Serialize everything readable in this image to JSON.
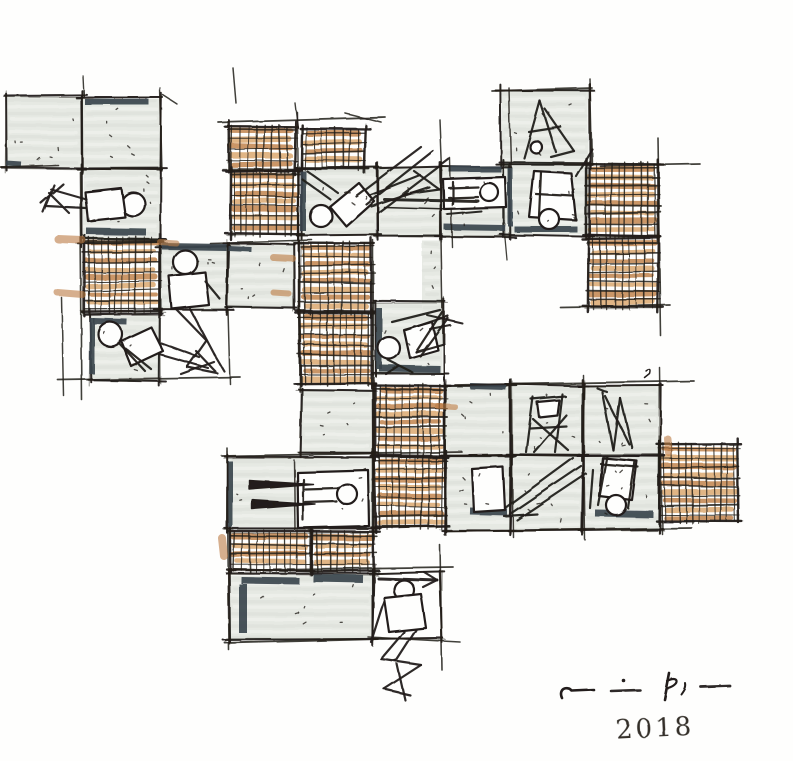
{
  "artwork": {
    "year": "2018"
  },
  "palette": {
    "paper": "#fefefd",
    "ink": "#221f1a",
    "gray_fill": "#e6e9e3",
    "gray_dark": "#dadfd8",
    "gray_light": "#f3f4f0",
    "slate": "#3a444d",
    "orange": "#bd7c42",
    "orange_light": "#d8a368"
  },
  "cells": [
    {
      "t": "g",
      "x": 6,
      "y": 96,
      "w": 76,
      "h": 72
    },
    {
      "t": "g",
      "x": 82,
      "y": 98,
      "w": 79,
      "h": 71
    },
    {
      "t": "g",
      "x": 82,
      "y": 169,
      "w": 79,
      "h": 74
    },
    {
      "t": "h",
      "x": 84,
      "y": 238,
      "w": 76,
      "h": 74
    },
    {
      "t": "g",
      "x": 160,
      "y": 246,
      "w": 68,
      "h": 64
    },
    {
      "t": "g",
      "x": 227,
      "y": 244,
      "w": 67,
      "h": 64
    },
    {
      "t": "g",
      "x": 90,
      "y": 315,
      "w": 70,
      "h": 66
    },
    {
      "t": "h",
      "x": 228,
      "y": 126,
      "w": 67,
      "h": 44
    },
    {
      "t": "h",
      "x": 302,
      "y": 129,
      "w": 63,
      "h": 39
    },
    {
      "t": "h",
      "x": 231,
      "y": 171,
      "w": 67,
      "h": 63
    },
    {
      "t": "g",
      "x": 301,
      "y": 167,
      "w": 76,
      "h": 68
    },
    {
      "t": "g",
      "x": 377,
      "y": 167,
      "w": 64,
      "h": 70
    },
    {
      "t": "g",
      "x": 441,
      "y": 167,
      "w": 69,
      "h": 70
    },
    {
      "t": "g",
      "x": 501,
      "y": 90,
      "w": 88,
      "h": 74
    },
    {
      "t": "g",
      "x": 504,
      "y": 163,
      "w": 85,
      "h": 72
    },
    {
      "t": "h",
      "x": 586,
      "y": 164,
      "w": 72,
      "h": 72
    },
    {
      "t": "h",
      "x": 588,
      "y": 238,
      "w": 70,
      "h": 69
    },
    {
      "t": "h",
      "x": 300,
      "y": 243,
      "w": 72,
      "h": 69
    },
    {
      "t": "h",
      "x": 300,
      "y": 313,
      "w": 72,
      "h": 70
    },
    {
      "t": "g",
      "x": 375,
      "y": 302,
      "w": 68,
      "h": 72
    },
    {
      "t": "gs",
      "x": 421,
      "y": 240,
      "w": 22,
      "h": 96
    },
    {
      "t": "g",
      "x": 301,
      "y": 390,
      "w": 72,
      "h": 63
    },
    {
      "t": "h",
      "x": 375,
      "y": 385,
      "w": 70,
      "h": 71
    },
    {
      "t": "h",
      "x": 375,
      "y": 457,
      "w": 70,
      "h": 70
    },
    {
      "t": "g",
      "x": 445,
      "y": 385,
      "w": 66,
      "h": 70
    },
    {
      "t": "g",
      "x": 511,
      "y": 385,
      "w": 72,
      "h": 70
    },
    {
      "t": "g",
      "x": 583,
      "y": 385,
      "w": 77,
      "h": 70
    },
    {
      "t": "g",
      "x": 445,
      "y": 455,
      "w": 66,
      "h": 75
    },
    {
      "t": "g",
      "x": 511,
      "y": 455,
      "w": 72,
      "h": 75
    },
    {
      "t": "g",
      "x": 583,
      "y": 455,
      "w": 77,
      "h": 75
    },
    {
      "t": "h",
      "x": 660,
      "y": 444,
      "w": 78,
      "h": 77
    },
    {
      "t": "g",
      "x": 228,
      "y": 457,
      "w": 146,
      "h": 71
    },
    {
      "t": "h",
      "x": 230,
      "y": 532,
      "w": 80,
      "h": 38
    },
    {
      "t": "h",
      "x": 312,
      "y": 532,
      "w": 62,
      "h": 38
    },
    {
      "t": "g",
      "x": 229,
      "y": 574,
      "w": 144,
      "h": 66
    },
    {
      "t": "o",
      "x": 373,
      "y": 572,
      "w": 68,
      "h": 67
    }
  ],
  "slate_bars": [
    [
      85,
      102,
      149,
      102,
      6
    ],
    [
      6,
      163,
      21,
      164,
      5
    ],
    [
      86,
      231,
      146,
      232,
      7
    ],
    [
      162,
      246,
      226,
      247,
      7
    ],
    [
      228,
      248,
      251,
      249,
      5
    ],
    [
      93,
      321,
      127,
      322,
      6
    ],
    [
      92,
      318,
      92,
      374,
      5
    ],
    [
      303,
      171,
      303,
      231,
      6
    ],
    [
      449,
      169,
      501,
      169,
      6
    ],
    [
      444,
      227,
      505,
      228,
      6
    ],
    [
      510,
      168,
      510,
      226,
      5
    ],
    [
      514,
      229,
      577,
      229,
      6
    ],
    [
      379,
      308,
      379,
      369,
      6
    ],
    [
      379,
      368,
      440,
      369,
      7
    ],
    [
      470,
      386,
      506,
      387,
      6
    ],
    [
      470,
      511,
      507,
      512,
      7
    ],
    [
      595,
      513,
      653,
      514,
      7
    ],
    [
      309,
      523,
      367,
      524,
      7
    ],
    [
      230,
      461,
      230,
      527,
      5
    ],
    [
      241,
      580,
      299,
      581,
      7
    ],
    [
      313,
      578,
      363,
      579,
      8
    ],
    [
      243,
      584,
      243,
      633,
      8
    ]
  ],
  "guides": [
    [
      233,
      68,
      236,
      103,
      1.5
    ],
    [
      83,
      76,
      84,
      97,
      1.4
    ],
    [
      160,
      88,
      162,
      171,
      1.4
    ],
    [
      0,
      167,
      58,
      165,
      1.6
    ],
    [
      80,
      172,
      82,
      400,
      1.6
    ],
    [
      62,
      298,
      64,
      396,
      1.5
    ],
    [
      58,
      380,
      240,
      377,
      1.8
    ],
    [
      228,
      310,
      230,
      384,
      1.5
    ],
    [
      218,
      122,
      385,
      117,
      1.8
    ],
    [
      295,
      103,
      298,
      128,
      1.4
    ],
    [
      345,
      113,
      381,
      122,
      1.6
    ],
    [
      440,
      120,
      442,
      170,
      1.5
    ],
    [
      509,
      88,
      511,
      167,
      1.5
    ],
    [
      492,
      91,
      592,
      88,
      1.8
    ],
    [
      590,
      79,
      592,
      164,
      1.5
    ],
    [
      658,
      138,
      661,
      336,
      1.6
    ],
    [
      600,
      166,
      700,
      164,
      1.7
    ],
    [
      560,
      307,
      670,
      305,
      1.7
    ],
    [
      297,
      112,
      300,
      392,
      1.4
    ],
    [
      373,
      240,
      374,
      540,
      1.5
    ],
    [
      210,
      243,
      312,
      240,
      1.6
    ],
    [
      222,
      456,
      462,
      452,
      1.8
    ],
    [
      445,
      531,
      692,
      528,
      1.8
    ],
    [
      455,
      385,
      694,
      381,
      1.8
    ],
    [
      511,
      379,
      513,
      537,
      1.5
    ],
    [
      583,
      375,
      585,
      540,
      1.5
    ],
    [
      660,
      368,
      662,
      534,
      1.5
    ],
    [
      228,
      570,
      453,
      567,
      1.8
    ],
    [
      225,
      643,
      378,
      639,
      1.9
    ],
    [
      368,
      637,
      460,
      642,
      1.6
    ],
    [
      440,
      545,
      442,
      670,
      1.6
    ],
    [
      227,
      448,
      229,
      650,
      1.6
    ],
    [
      450,
      158,
      452,
      247,
      1.4
    ],
    [
      505,
      238,
      507,
      260,
      1.3
    ],
    [
      163,
      95,
      177,
      104,
      1.5
    ],
    [
      441,
      240,
      443,
      345,
      1.5
    ],
    [
      294,
      460,
      295,
      528,
      1.5
    ]
  ],
  "orange_strays": [
    [
      58,
      239,
      82,
      240,
      8
    ],
    [
      58,
      293,
      83,
      295,
      7
    ],
    [
      160,
      242,
      176,
      243,
      6
    ],
    [
      273,
      257,
      292,
      258,
      7
    ],
    [
      274,
      293,
      289,
      294,
      6
    ],
    [
      222,
      538,
      224,
      556,
      8
    ],
    [
      668,
      439,
      669,
      453,
      7
    ],
    [
      438,
      406,
      455,
      407,
      6
    ]
  ],
  "strokes": [
    {
      "t": "c",
      "x": 133,
      "y": 204,
      "r": 12
    },
    {
      "t": "p",
      "d": "M85 192 L121 188 L125 217 L88 221 Z",
      "f": "paper"
    },
    {
      "t": "l",
      "p": [
        86,
        199,
        51,
        189
      ]
    },
    {
      "t": "l",
      "p": [
        86,
        208,
        46,
        206
      ]
    },
    {
      "t": "l",
      "p": [
        54,
        185,
        43,
        212
      ]
    },
    {
      "t": "l",
      "p": [
        63,
        184,
        41,
        203
      ]
    },
    {
      "t": "l",
      "p": [
        49,
        193,
        69,
        213
      ]
    },
    {
      "t": "c",
      "x": 185,
      "y": 262,
      "r": 12
    },
    {
      "t": "p",
      "d": "M169 276 L205 272 L209 305 L172 309 Z",
      "f": "paper"
    },
    {
      "t": "l",
      "p": [
        205,
        281,
        220,
        299
      ]
    },
    {
      "t": "l",
      "p": [
        176,
        309,
        206,
        340
      ]
    },
    {
      "t": "l",
      "p": [
        190,
        309,
        214,
        354
      ]
    },
    {
      "t": "l",
      "p": [
        206,
        340,
        187,
        367
      ]
    },
    {
      "t": "l",
      "p": [
        214,
        354,
        224,
        371
      ]
    },
    {
      "t": "l",
      "p": [
        187,
        367,
        217,
        373
      ]
    },
    {
      "t": "c",
      "x": 110,
      "y": 334,
      "r": 12
    },
    {
      "t": "p",
      "d": "M121 341 L151 327 L163 351 L131 366 Z",
      "f": "paper"
    },
    {
      "t": "l",
      "p": [
        161,
        343,
        199,
        357
      ]
    },
    {
      "t": "l",
      "p": [
        159,
        354,
        208,
        368
      ]
    },
    {
      "t": "l",
      "p": [
        196,
        351,
        215,
        371
      ]
    },
    {
      "t": "l",
      "p": [
        214,
        362,
        181,
        374
      ]
    },
    {
      "t": "l",
      "p": [
        125,
        348,
        151,
        369
      ]
    },
    {
      "t": "l",
      "p": [
        118,
        342,
        145,
        371
      ]
    },
    {
      "t": "c",
      "x": 321,
      "y": 216,
      "r": 11
    },
    {
      "t": "p",
      "d": "M330 207 L359 183 L374 201 L346 226 Z",
      "f": "paper"
    },
    {
      "t": "l",
      "p": [
        331,
        200,
        302,
        179
      ]
    },
    {
      "t": "l",
      "p": [
        338,
        193,
        307,
        171
      ]
    },
    {
      "t": "l",
      "p": [
        369,
        195,
        420,
        175
      ]
    },
    {
      "t": "l",
      "p": [
        371,
        206,
        429,
        187
      ]
    },
    {
      "t": "l",
      "p": [
        414,
        171,
        439,
        189
      ]
    },
    {
      "t": "l",
      "p": [
        439,
        189,
        403,
        194
      ]
    },
    {
      "t": "l",
      "p": [
        356,
        196,
        421,
        147
      ]
    },
    {
      "t": "l",
      "p": [
        366,
        204,
        433,
        151
      ]
    },
    {
      "t": "l",
      "p": [
        378,
        213,
        449,
        159
      ]
    },
    {
      "t": "p",
      "d": "M443 179 L505 177 L506 207 L444 209 Z",
      "f": "paper"
    },
    {
      "t": "c",
      "x": 489,
      "y": 192,
      "r": 9
    },
    {
      "t": "l",
      "p": [
        449,
        188,
        478,
        187
      ]
    },
    {
      "t": "l",
      "p": [
        449,
        198,
        478,
        197
      ]
    },
    {
      "t": "l",
      "p": [
        453,
        182,
        453,
        204
      ]
    },
    {
      "t": "l",
      "p": [
        384,
        199,
        478,
        201
      ],
      "w": 3
    },
    {
      "t": "l",
      "p": [
        384,
        207,
        449,
        209
      ],
      "w": 1.5
    },
    {
      "t": "l",
      "p": [
        447,
        214,
        481,
        211
      ],
      "w": 2
    },
    {
      "t": "l",
      "p": [
        540,
        101,
        524,
        158
      ]
    },
    {
      "t": "l",
      "p": [
        540,
        101,
        556,
        152
      ]
    },
    {
      "t": "l",
      "p": [
        529,
        132,
        561,
        127
      ]
    },
    {
      "t": "l",
      "p": [
        545,
        109,
        574,
        151
      ]
    },
    {
      "t": "l",
      "p": [
        574,
        151,
        551,
        157
      ]
    },
    {
      "t": "c",
      "x": 536,
      "y": 147,
      "r": 6
    },
    {
      "t": "p",
      "d": "M534 171 L571 173 L576 220 L529 217 Z",
      "f": "paper"
    },
    {
      "t": "c",
      "x": 549,
      "y": 219,
      "r": 10
    },
    {
      "t": "l",
      "p": [
        576,
        176,
        592,
        149
      ]
    },
    {
      "t": "l",
      "p": [
        536,
        194,
        573,
        196
      ]
    },
    {
      "t": "l",
      "p": [
        541,
        172,
        539,
        216
      ]
    },
    {
      "t": "c",
      "x": 389,
      "y": 348,
      "r": 11
    },
    {
      "t": "p",
      "d": "M404 330 L432 322 L438 350 L410 358 Z",
      "f": "paper"
    },
    {
      "t": "l",
      "p": [
        392,
        322,
        440,
        310
      ]
    },
    {
      "t": "l",
      "p": [
        406,
        330,
        448,
        316
      ]
    },
    {
      "t": "l",
      "p": [
        442,
        312,
        416,
        352
      ]
    },
    {
      "t": "l",
      "p": [
        448,
        318,
        420,
        356
      ]
    },
    {
      "t": "l",
      "p": [
        416,
        352,
        444,
        344
      ]
    },
    {
      "t": "l",
      "p": [
        388,
        360,
        412,
        372
      ]
    },
    {
      "t": "l",
      "p": [
        398,
        366,
        386,
        374
      ]
    },
    {
      "t": "l",
      "p": [
        427,
        315,
        462,
        323
      ],
      "w": 2
    },
    {
      "t": "l",
      "p": [
        430,
        329,
        450,
        325
      ],
      "w": 2
    },
    {
      "t": "p",
      "d": "M646 371 Q652 367 650 374 L645 378",
      "w": 1.5
    },
    {
      "t": "l",
      "p": [
        533,
        397,
        526,
        452
      ]
    },
    {
      "t": "l",
      "p": [
        562,
        394,
        555,
        452
      ]
    },
    {
      "t": "l",
      "p": [
        531,
        399,
        565,
        396
      ]
    },
    {
      "t": "l",
      "p": [
        530,
        428,
        566,
        426
      ]
    },
    {
      "t": "l",
      "p": [
        533,
        419,
        568,
        450
      ]
    },
    {
      "t": "l",
      "p": [
        566,
        415,
        534,
        452
      ]
    },
    {
      "t": "p",
      "d": "M537 402 L559 400 L557 415 L539 417 Z",
      "f": "paper"
    },
    {
      "t": "l",
      "p": [
        602,
        392,
        613,
        450
      ]
    },
    {
      "t": "l",
      "p": [
        613,
        450,
        620,
        398
      ]
    },
    {
      "t": "l",
      "p": [
        620,
        398,
        632,
        448
      ]
    },
    {
      "t": "l",
      "p": [
        605,
        396,
        629,
        444
      ]
    },
    {
      "t": "l",
      "p": [
        597,
        388,
        607,
        392
      ]
    },
    {
      "t": "p",
      "d": "M472 469 L503 467 L505 510 L474 512 Z",
      "f": "paper"
    },
    {
      "t": "l",
      "p": [
        505,
        508,
        573,
        458
      ]
    },
    {
      "t": "l",
      "p": [
        510,
        514,
        581,
        466
      ]
    },
    {
      "t": "l",
      "p": [
        517,
        520,
        586,
        474
      ]
    },
    {
      "t": "l",
      "p": [
        504,
        516,
        537,
        514
      ]
    },
    {
      "t": "p",
      "d": "M603 458 L637 461 L632 500 L599 496 Z",
      "f": "paper"
    },
    {
      "t": "c",
      "x": 616,
      "y": 505,
      "r": 10
    },
    {
      "t": "l",
      "p": [
        607,
        456,
        598,
        505
      ]
    },
    {
      "t": "l",
      "p": [
        635,
        461,
        628,
        508
      ]
    },
    {
      "t": "l",
      "p": [
        593,
        470,
        590,
        508
      ]
    },
    {
      "t": "l",
      "p": [
        638,
        467,
        601,
        464
      ]
    },
    {
      "t": "p",
      "d": "M297 472 L368 470 L369 526 L298 528 Z",
      "f": "paper"
    },
    {
      "t": "c",
      "x": 347,
      "y": 494,
      "r": 10
    },
    {
      "t": "l",
      "p": [
        305,
        489,
        337,
        488
      ]
    },
    {
      "t": "l",
      "p": [
        305,
        502,
        336,
        501
      ]
    },
    {
      "t": "l",
      "p": [
        303,
        479,
        303,
        520
      ]
    },
    {
      "t": "p",
      "d": "M249 480 L313 484 L249 489 Z",
      "f": "ink",
      "w": 1.4
    },
    {
      "t": "p",
      "d": "M252 500 L315 504 L252 509 Z",
      "f": "ink",
      "w": 1.4
    },
    {
      "t": "l",
      "p": [
        378,
        578,
        437,
        580
      ],
      "w": 3
    },
    {
      "t": "l",
      "p": [
        437,
        580,
        424,
        572
      ]
    },
    {
      "t": "l",
      "p": [
        437,
        580,
        423,
        587
      ]
    },
    {
      "t": "c",
      "x": 404,
      "y": 590,
      "r": 10
    },
    {
      "t": "p",
      "d": "M384 598 L421 594 L426 628 L389 632 Z",
      "f": "paper"
    },
    {
      "t": "l",
      "p": [
        384,
        601,
        371,
        642
      ]
    },
    {
      "t": "l",
      "p": [
        404,
        632,
        381,
        659
      ]
    },
    {
      "t": "l",
      "p": [
        416,
        630,
        396,
        661
      ]
    },
    {
      "t": "l",
      "p": [
        381,
        659,
        421,
        665
      ]
    },
    {
      "t": "l",
      "p": [
        421,
        665,
        384,
        689
      ]
    },
    {
      "t": "l",
      "p": [
        384,
        689,
        410,
        695
      ]
    },
    {
      "t": "l",
      "p": [
        397,
        664,
        405,
        700
      ]
    }
  ],
  "signature": {
    "strokes": [
      {
        "t": "p",
        "d": "M562 698 C558 689 567 685 572 691 L594 690",
        "w": 2.6
      },
      {
        "t": "l",
        "p": [
          611,
          691,
          640,
          690
        ],
        "w": 2.6
      },
      {
        "t": "cf",
        "x": 624,
        "y": 681,
        "r": 1.8
      },
      {
        "t": "p",
        "d": "M669 673 L664 699",
        "w": 2.6
      },
      {
        "t": "p",
        "d": "M667 681 C678 675 681 684 668 688",
        "w": 2.2
      },
      {
        "t": "p",
        "d": "M685 683 C686 688 683 691 681 694",
        "w": 2
      },
      {
        "t": "l",
        "p": [
          701,
          687,
          730,
          686
        ],
        "w": 2.8
      }
    ]
  }
}
